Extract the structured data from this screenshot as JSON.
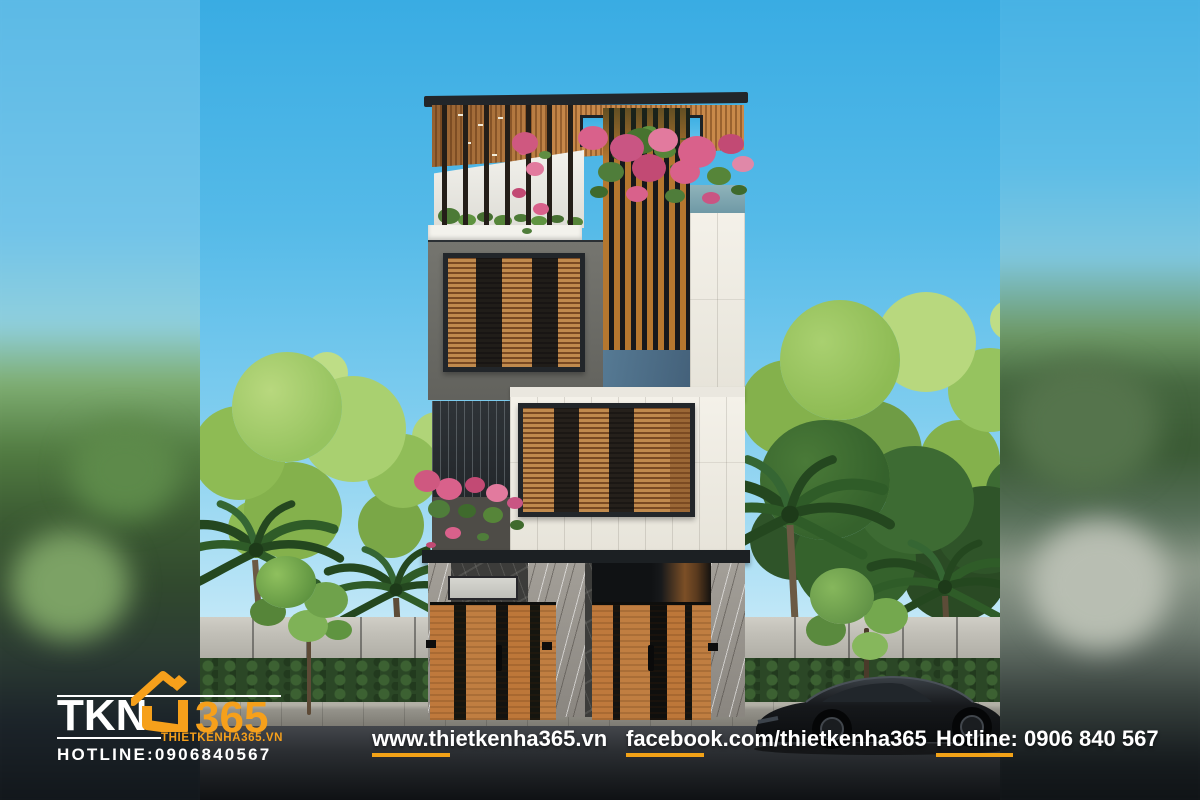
{
  "meta": {
    "alt": "3D exterior render of a modern four-storey tube house with wooden louver facade, rooftop pergola garden with pink bougainvillea, concrete fence, street trees, palms and a black sports car parked on the road"
  },
  "branding": {
    "logo_text_primary": "TKN",
    "logo_text_secondary": "365",
    "logo_icon": "house-roof-icon",
    "website_small": "THIETKENHA365.VN",
    "hotline_small": "HOTLINE:0906840567",
    "accent_orange": "#F6A01B",
    "text_white": "#FFFFFF"
  },
  "footer": {
    "website": {
      "label": "www.thietkenha365.vn"
    },
    "facebook": {
      "label": "facebook.com/thietkenha365"
    },
    "hotline": {
      "label": "Hotline: 0906 840 567"
    },
    "underline_color": "#F2A217",
    "text_color": "#FFFFFF"
  },
  "palette": {
    "sky_top": "#39ACE3",
    "sky_bottom": "#E2F4FB",
    "wood_louver": "#C08A4D",
    "wood_dark": "#7A4A22",
    "wall_white_tile": "#F0EDE5",
    "wall_grey_stucco": "#70706C",
    "glass_blue_panel": "#567A94",
    "roof_dark": "#22262A",
    "fence_concrete": "#C2C0B8",
    "hedge_green": "#2B4726",
    "road_dark": "#1B1E21",
    "flower_pink": "#D9618B",
    "foliage_light": "#A4CB68",
    "foliage_dark": "#2F5C28",
    "gate_wood": "#C07E41",
    "marble_light": "#96928B"
  }
}
